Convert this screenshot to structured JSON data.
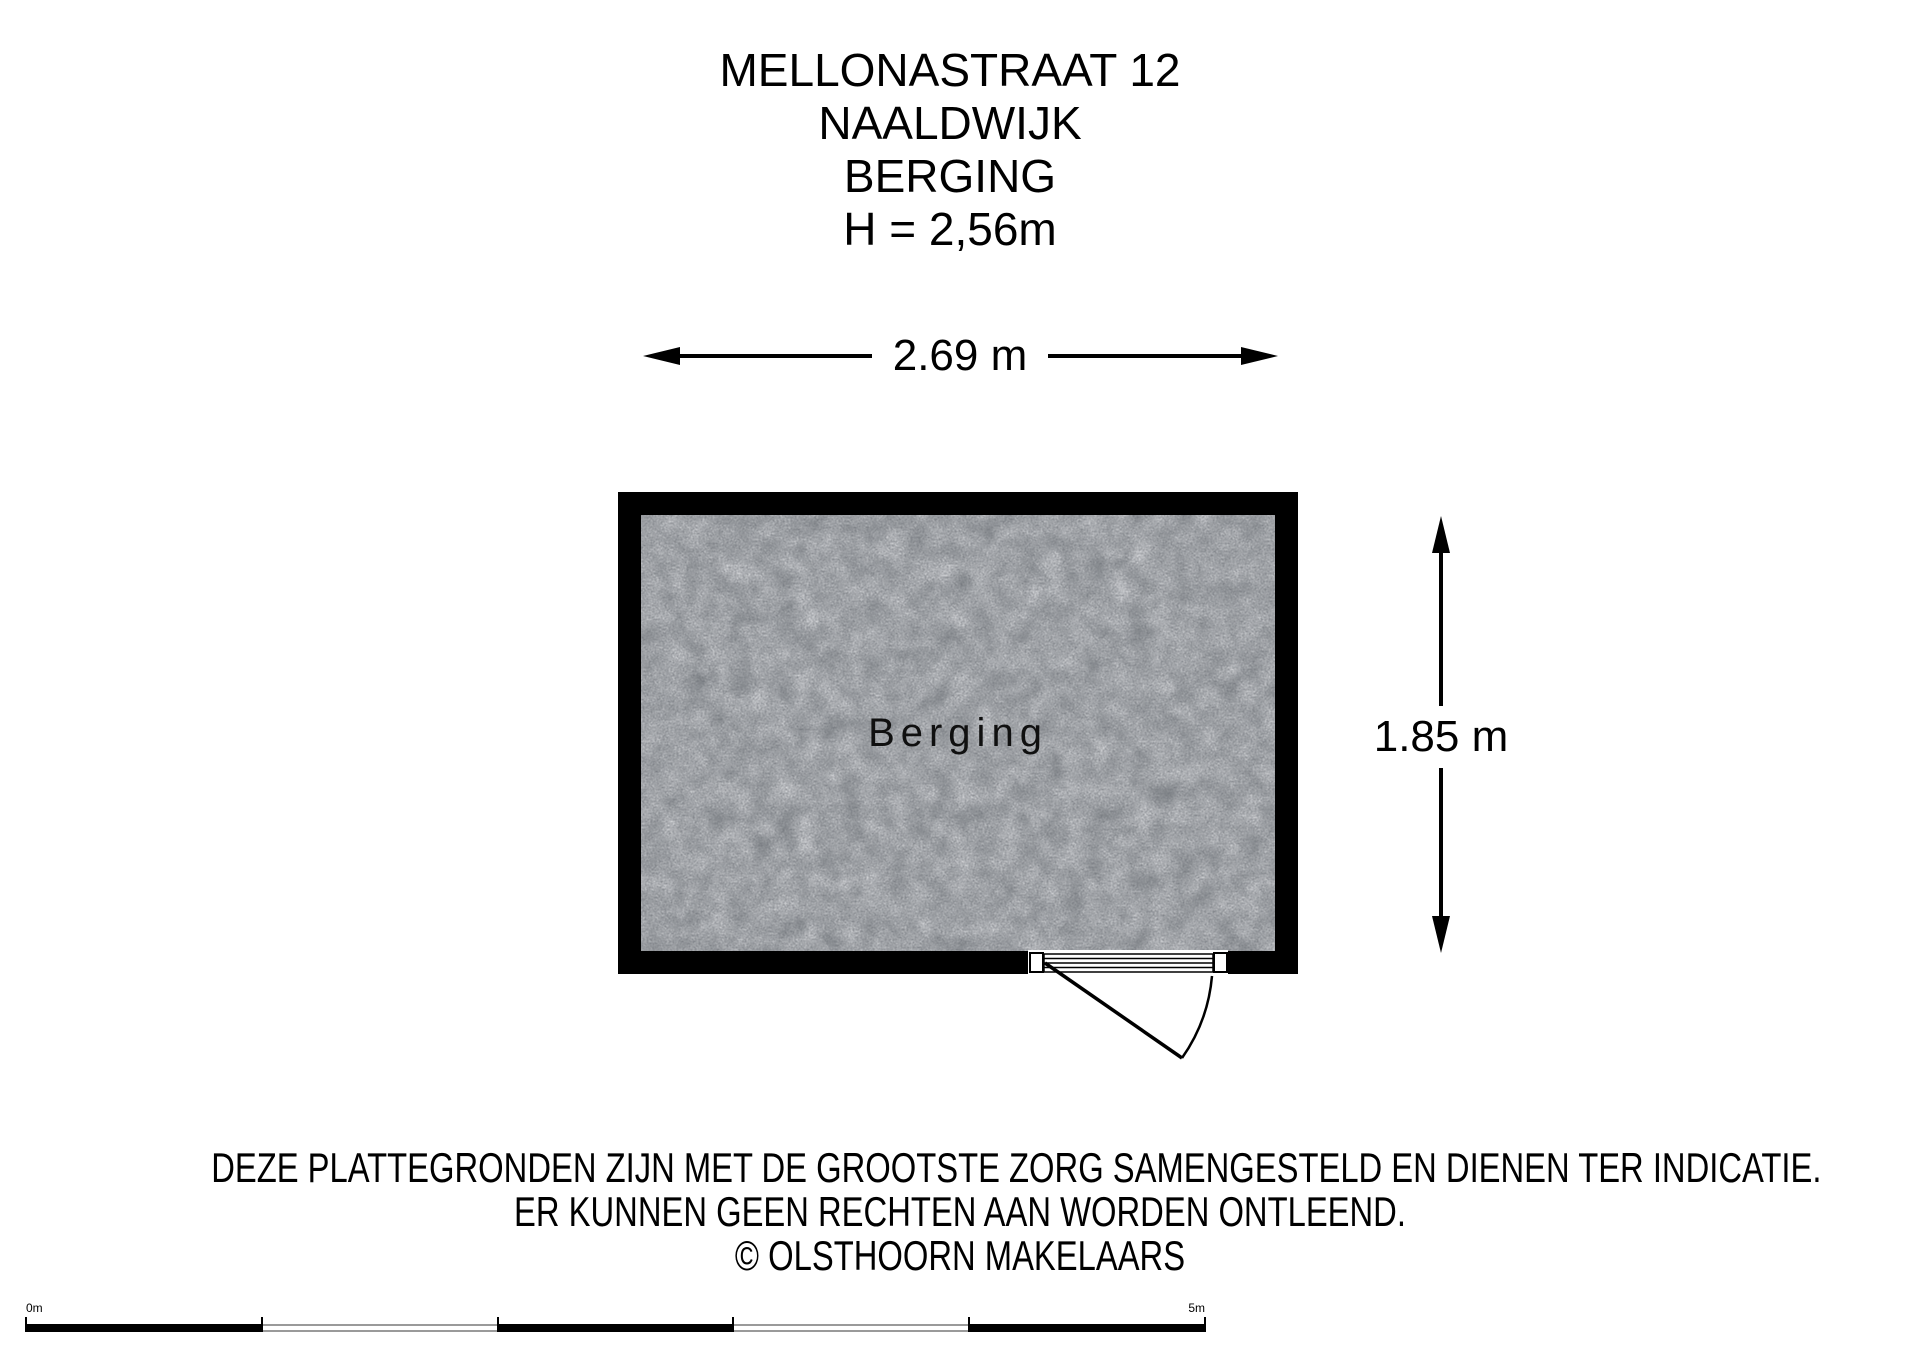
{
  "title": {
    "lines": [
      "MELLONASTRAAT 12",
      "NAALDWIJK",
      "BERGING",
      "H = 2,56m"
    ]
  },
  "floorplan": {
    "room_label": "Berging",
    "width_label": "2.69 m",
    "height_label": "1.85 m",
    "wall_color": "#000000",
    "floor_color": "#878b8f"
  },
  "disclaimer": {
    "lines": [
      "DEZE PLATTEGRONDEN ZIJN MET DE GROOTSTE ZORG SAMENGESTELD EN DIENEN TER INDICATIE.",
      "ER KUNNEN GEEN RECHTEN AAN WORDEN ONTLEEND.",
      "© OLSTHOORN MAKELAARS"
    ]
  },
  "scale_bar": {
    "start_label": "0m",
    "end_label": "5m"
  }
}
